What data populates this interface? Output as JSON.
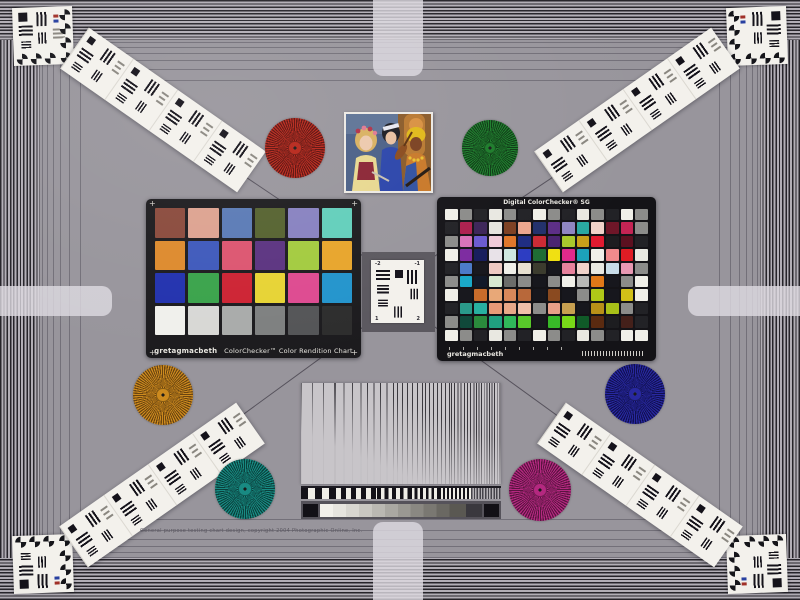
{
  "colors": {
    "background": "#98959c",
    "stripe_dark": "#26242a",
    "stripe_light": "#b2aeb6",
    "card_black": "#1c1b1e",
    "card_white": "#f3f1ec",
    "tab": "#ded9e2",
    "diagonal_line": "#56525c"
  },
  "colorchecker": {
    "brand": "gretagmacbeth",
    "label": "ColorChecker™ Color Rendition Chart",
    "corner_mark": "+",
    "cols": 6,
    "patches": [
      "#8a4a3c",
      "#dda290",
      "#5a7ab5",
      "#55622f",
      "#8781c0",
      "#62cebb",
      "#dd8a2d",
      "#3e59bb",
      "#dc5570",
      "#5b3380",
      "#a3cb3f",
      "#e7a52b",
      "#2232ae",
      "#3aa34b",
      "#cd2333",
      "#e7d334",
      "#dd4a90",
      "#2394cc",
      "#f0f0ec",
      "#d8d8d5",
      "#a9abaa",
      "#7e8080",
      "#545557",
      "#2d2d2d"
    ]
  },
  "sg": {
    "title": "Digital ColorChecker® SG",
    "brand": "gretagmacbeth",
    "cols": 14,
    "patches": [
      "#f0efe8",
      "#8c8c8a",
      "#222226",
      "#e9e8e1",
      "#8c8c8a",
      "#222226",
      "#f0efe8",
      "#8c8c8a",
      "#222226",
      "#e9e8e1",
      "#8c8c8a",
      "#222226",
      "#f0efe8",
      "#8c8c8a",
      "#222226",
      "#ad1f4e",
      "#3c2458",
      "#e6e4de",
      "#7d4022",
      "#eca68e",
      "#22306c",
      "#5c2e86",
      "#8f86c2",
      "#2aa8a2",
      "#f0d2ca",
      "#6e1628",
      "#c42454",
      "#8c8c8a",
      "#8c8c8a",
      "#d873b8",
      "#6a5ad0",
      "#f0cad8",
      "#e0762a",
      "#1e2c82",
      "#cc2a34",
      "#4a2470",
      "#a8c82c",
      "#c8a01a",
      "#e01a30",
      "#1d1d20",
      "#5c1020",
      "#222226",
      "#f0efe8",
      "#7c2aa0",
      "#161c5c",
      "#e8e2e8",
      "#d0e8e0",
      "#2c3cc2",
      "#1e6c34",
      "#f0e012",
      "#e02a8c",
      "#1ca2ba",
      "#f0efe8",
      "#f08a8c",
      "#e01c24",
      "#e9e8e1",
      "#222226",
      "#4a7ac8",
      "#17171d",
      "#eecac2",
      "#f0efe8",
      "#e8e0d0",
      "#3c3c2e",
      "#17171d",
      "#e8829c",
      "#f0d2ca",
      "#e9e8e1",
      "#c8dce8",
      "#e898b2",
      "#8c8c8a",
      "#8c8c8a",
      "#18a8c8",
      "#101828",
      "#d8e8d0",
      "#6c6c6a",
      "#8c8c8a",
      "#17171d",
      "#8c8c8a",
      "#f0efe8",
      "#b8b8b6",
      "#e07818",
      "#17171d",
      "#8c8c8a",
      "#f0efe8",
      "#f0efe8",
      "#17171d",
      "#c86c2a",
      "#e8a878",
      "#d8885a",
      "#b8683a",
      "#17171d",
      "#8a4a20",
      "#17171d",
      "#8c8c8a",
      "#b0c818",
      "#17171d",
      "#d2c018",
      "#f0efe8",
      "#222226",
      "#2a9a8a",
      "#28b0a0",
      "#e89a78",
      "#e8a888",
      "#f0c0a8",
      "#8c8c8a",
      "#e8a088",
      "#c8a050",
      "#17171d",
      "#b89018",
      "#a8c018",
      "#8c8c8a",
      "#222226",
      "#8c8c8a",
      "#10493a",
      "#2a8a3c",
      "#20a080",
      "#30b85a",
      "#58c82a",
      "#17171d",
      "#38b828",
      "#78d818",
      "#105a28",
      "#5a2a10",
      "#1d1d20",
      "#44201a",
      "#222226",
      "#f0efe8",
      "#8c8c8a",
      "#222226",
      "#e9e8e1",
      "#8c8c8a",
      "#222226",
      "#f0efe8",
      "#8c8c8a",
      "#222226",
      "#e9e8e1",
      "#8c8c8a",
      "#222226",
      "#f0efe8",
      "#f0efe8"
    ]
  },
  "stars": [
    {
      "name": "siemens-star-red",
      "x": 295,
      "y": 148,
      "d": 60,
      "c1": "#b62418",
      "c2": "#5a0e0a"
    },
    {
      "name": "siemens-star-green",
      "x": 490,
      "y": 148,
      "d": 56,
      "c1": "#1c7c2a",
      "c2": "#0c3a14"
    },
    {
      "name": "siemens-star-orange",
      "x": 163,
      "y": 395,
      "d": 60,
      "c1": "#cc8a1e",
      "c2": "#6a4410"
    },
    {
      "name": "siemens-star-blue",
      "x": 635,
      "y": 394,
      "d": 60,
      "c1": "#2828a0",
      "c2": "#101050"
    },
    {
      "name": "siemens-star-teal",
      "x": 245,
      "y": 489,
      "d": 60,
      "c1": "#188a82",
      "c2": "#0a403c"
    },
    {
      "name": "siemens-star-magenta",
      "x": 540,
      "y": 490,
      "d": 62,
      "c1": "#b42880",
      "c2": "#5a1440"
    }
  ],
  "usaf": {
    "tl": "-2",
    "tr": "-1",
    "bl": "1",
    "br": "2"
  },
  "fine_print": "General purpose testing chart design, copyright 2004 Photographic Online, Inc."
}
